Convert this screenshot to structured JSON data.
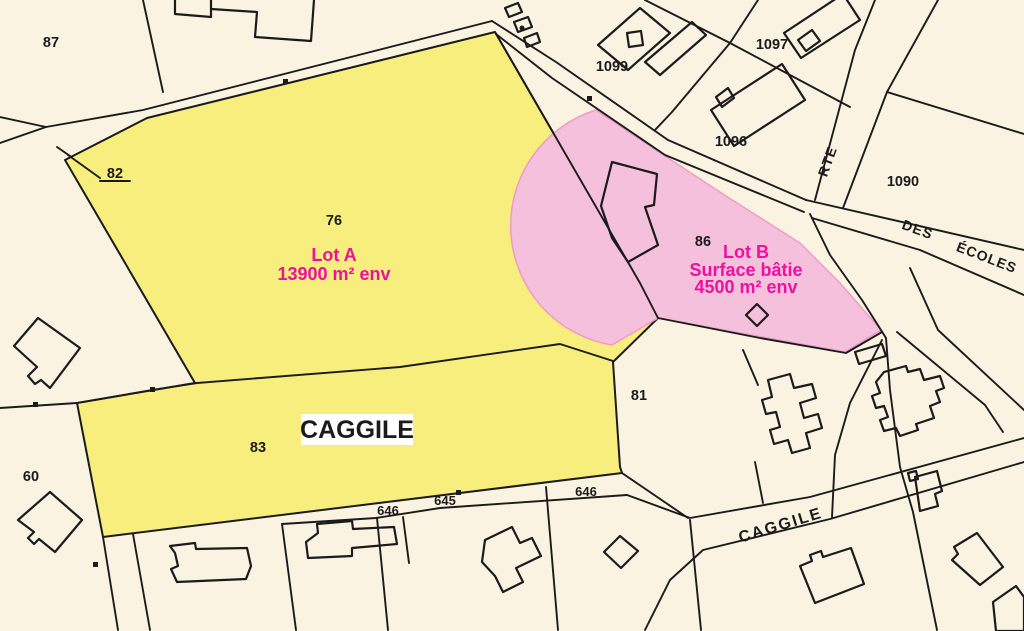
{
  "map": {
    "parcels": {
      "p87": "87",
      "p82": "82",
      "p76": "76",
      "p83": "83",
      "p60": "60",
      "p81": "81",
      "p86": "86",
      "p1099": "1099",
      "p1097": "1097",
      "p1096": "1096",
      "p1090": "1090",
      "p645": "645",
      "p646a": "646",
      "p646b": "646"
    },
    "lots": {
      "lot_a": {
        "name": "Lot A",
        "area": "13900 m² env"
      },
      "lot_b": {
        "name": "Lot B",
        "type": "Surface bâtie",
        "area": "4500 m² env"
      }
    },
    "streets": {
      "rte": "RTE",
      "des": "DES",
      "ecoles": "ÉCOLES",
      "caggile_street": "CAGGILE"
    },
    "place_label": "CAGGILE",
    "colors": {
      "background": "#faf3e2",
      "yellow": "#f7ee7d",
      "pink": "#f5c0db",
      "pink_edge": "#ee9cc8",
      "magenta": "#ee119e",
      "line": "#1b1b1b"
    }
  }
}
